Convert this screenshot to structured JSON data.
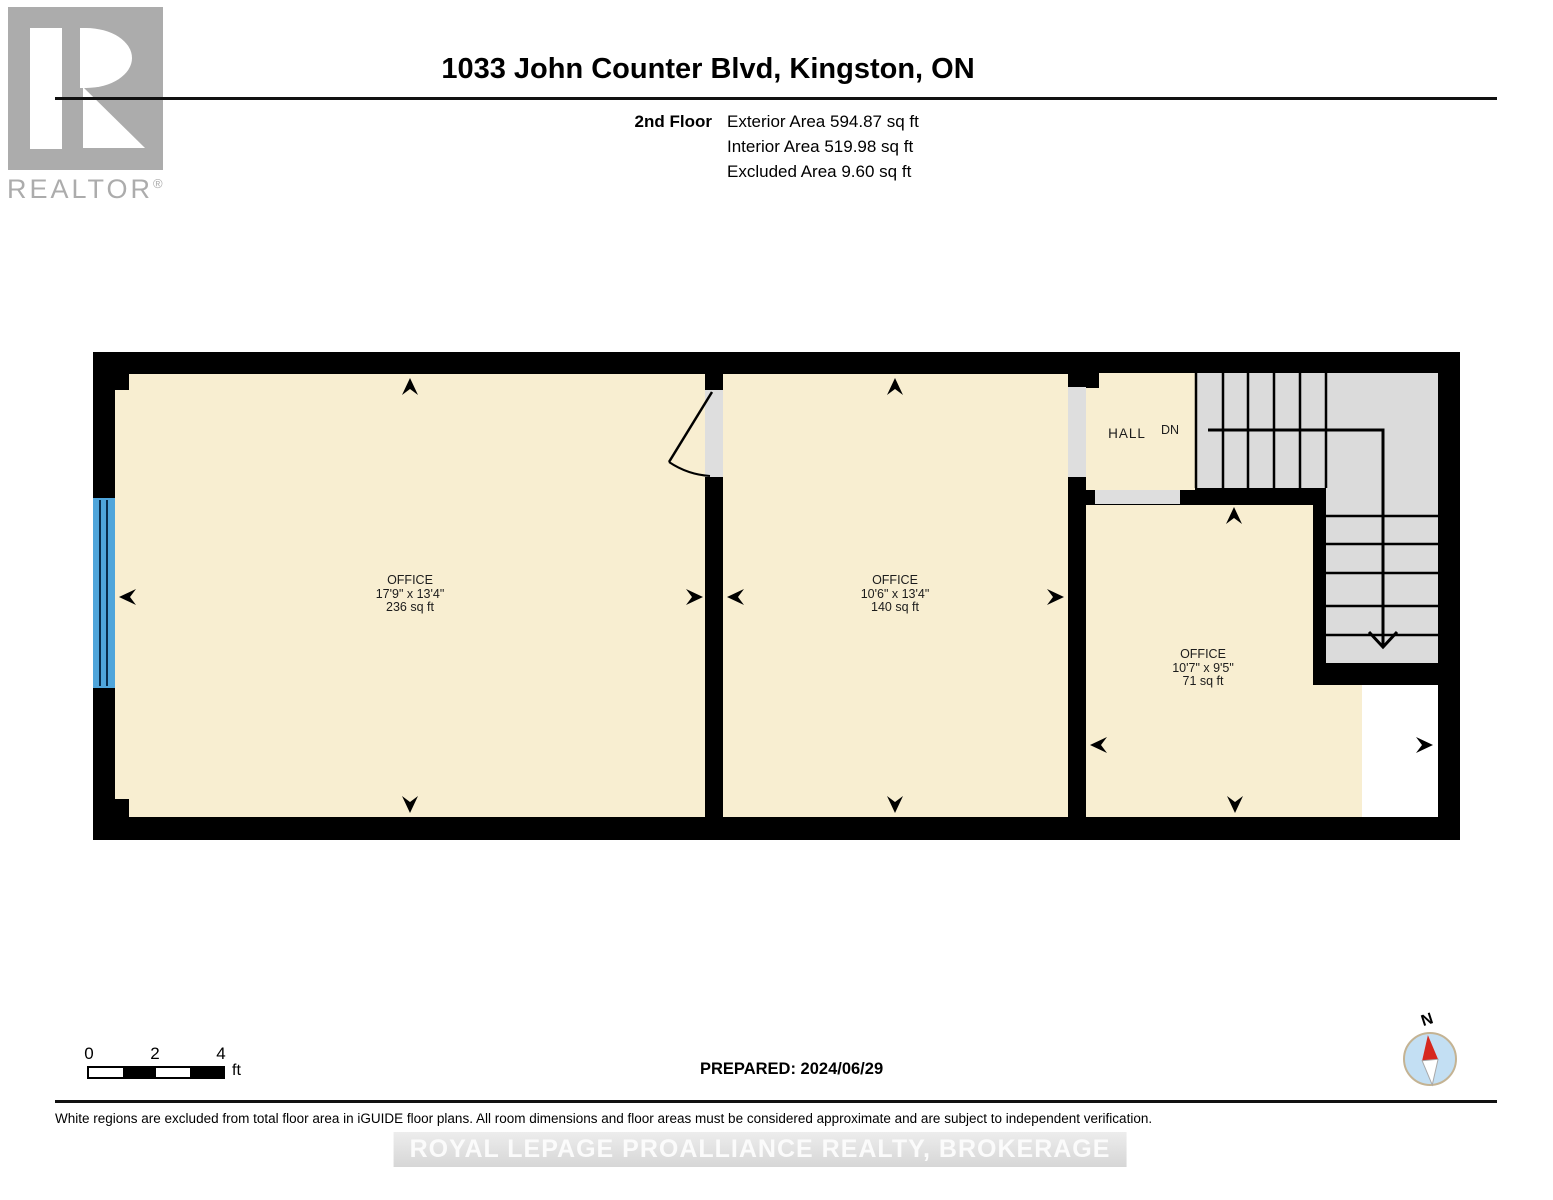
{
  "header": {
    "logo_text": "REALTOR",
    "logo_reg": "®",
    "title": "1033 John Counter Blvd, Kingston, ON",
    "floor_label": "2nd Floor",
    "areas": [
      "Exterior Area 594.87 sq ft",
      "Interior Area 519.98 sq ft",
      "Excluded Area 9.60 sq ft"
    ]
  },
  "plan": {
    "rooms": [
      {
        "name": "OFFICE",
        "dims": "17'9\" x 13'4\"",
        "area": "236 sq ft"
      },
      {
        "name": "OFFICE",
        "dims": "10'6\" x 13'4\"",
        "area": "140 sq ft"
      },
      {
        "name": "OFFICE",
        "dims": "10'7\" x 9'5\"",
        "area": "71 sq ft"
      }
    ],
    "hall": "HALL",
    "stairs_direction": "DN"
  },
  "footer": {
    "scale_ticks": [
      "0",
      "2",
      "4"
    ],
    "scale_unit": "ft",
    "prepared": "PREPARED: 2024/06/29",
    "compass": "N",
    "disclaimer": "White regions are excluded from total floor area in iGUIDE floor plans. All room dimensions and floor areas must be considered approximate and are subject to independent verification.",
    "watermark": "ROYAL LEPAGE PROALLIANCE REALTY, BROKERAGE"
  },
  "colors": {
    "room-fill": "#F8EED1",
    "stair-fill": "#DBDBDB",
    "door-fill": "#DEDEDE",
    "wall": "#000000",
    "window-blue": "#4FA5DB",
    "logo-gray": "#ACACAC",
    "compass-blue": "#C3DFF3",
    "compass-red": "#D6281E",
    "compass-ring": "#C4B393"
  }
}
